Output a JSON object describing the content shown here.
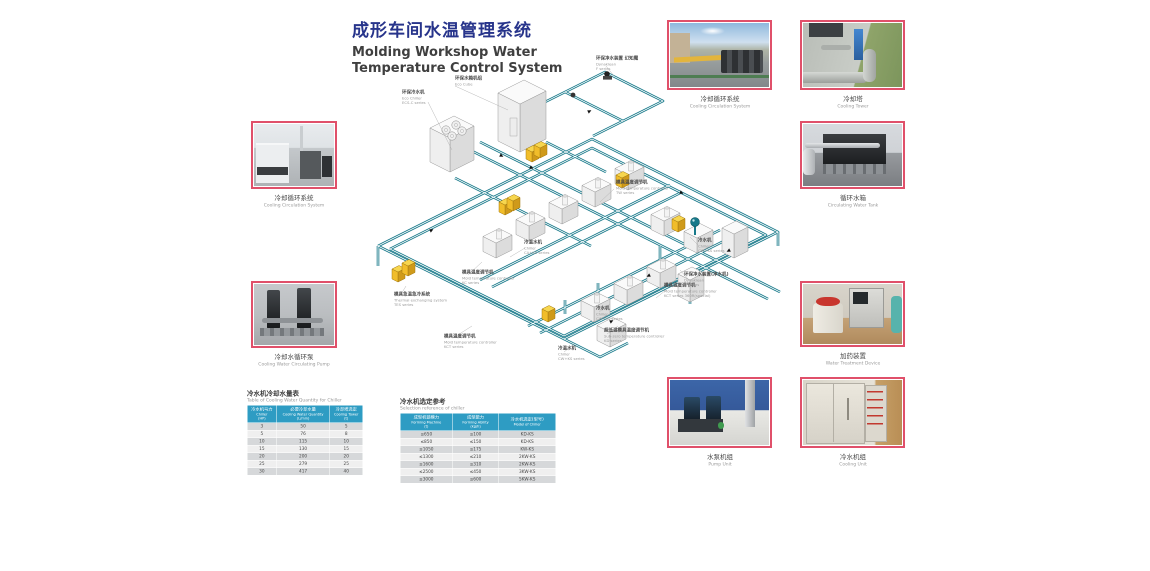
{
  "title": {
    "zh": "成形车间水温管理系统",
    "en_line1": "Molding Workshop Water",
    "en_line2": "Temperature Control System"
  },
  "photos": {
    "left_top": {
      "zh": "冷却循环系统",
      "en": "Cooling Circulation System"
    },
    "left_bottom": {
      "zh": "冷却水循环泵",
      "en": "Cooling Water Circulating Pump"
    },
    "top_1": {
      "zh": "冷却循环系统",
      "en": "Cooling Circulation System"
    },
    "top_2": {
      "zh": "冷却塔",
      "en": "Cooling Tower"
    },
    "right_1": {
      "zh": "循环水箱",
      "en": "Circulating Water Tank"
    },
    "right_2": {
      "zh": "加药装置",
      "en": "Water Treatment Device"
    },
    "bottom_1": {
      "zh": "水泵机组",
      "en": "Pump Unit"
    },
    "bottom_2": {
      "zh": "冷水机组",
      "en": "Cooling Unit"
    }
  },
  "diagram": {
    "labels": [
      {
        "zh": "环保水箱机组",
        "en": "Eco Cube",
        "series": ""
      },
      {
        "zh": "环保冷水机",
        "en": "Eco Chiller",
        "series": "ECS-C series"
      },
      {
        "zh": "环保净水装置 幻知魔",
        "en": "Dynaklean",
        "series": "F series"
      },
      {
        "zh": "模具温度调节机",
        "en": "Mold temperature controller",
        "series": "TW series"
      },
      {
        "zh": "冷温水机",
        "en": "Chiller",
        "series": "CA+KS series"
      },
      {
        "zh": "模具温度调节机",
        "en": "Mold temperature controller",
        "series": "KC series"
      },
      {
        "zh": "模具急温急冷系统",
        "en": "Thermal exchanging system",
        "series": "TES series"
      },
      {
        "zh": "模具温度调节机",
        "en": "Mold temperature controller",
        "series": "KCT series"
      },
      {
        "zh": "模具温度调节机",
        "en": "Mold temperature controller",
        "series": "KCT series 360R(special)"
      },
      {
        "zh": "冷水机",
        "en": "Chiller",
        "series": "CW+KS series"
      },
      {
        "zh": "环保净水装置(净水机)",
        "en": "Dynaklean",
        "series": "D series"
      },
      {
        "zh": "冷水机",
        "en": "Chiller",
        "series": "CW+KS series"
      },
      {
        "zh": "超低温模具温度调节机",
        "en": "Sub-zero temperature controller",
        "series": "KD series"
      },
      {
        "zh": "冷温水机",
        "en": "Chiller",
        "series": "CW+KS series"
      }
    ]
  },
  "tables": {
    "chiller_water": {
      "title_zh": "冷水机冷却水量表",
      "title_en": "Table of Cooling Water Quantity for Chiller",
      "columns": [
        {
          "zh": "冷水机马力",
          "en": "Chiller",
          "unit": "(HP)"
        },
        {
          "zh": "必要冷却水量",
          "en": "Cooling Water Quantity",
          "unit": "(L/min)"
        },
        {
          "zh": "冷却塔选定",
          "en": "Cooling Tower",
          "unit": "(t)"
        }
      ],
      "rows": [
        [
          "3",
          "50",
          "5"
        ],
        [
          "5",
          "76",
          "8"
        ],
        [
          "10",
          "115",
          "10"
        ],
        [
          "15",
          "130",
          "15"
        ],
        [
          "20",
          "200",
          "20"
        ],
        [
          "25",
          "279",
          "25"
        ],
        [
          "30",
          "417",
          "40"
        ]
      ]
    },
    "chiller_selection": {
      "title_zh": "冷水机选定参考",
      "title_en": "Selection reference of chiller",
      "columns": [
        {
          "zh": "成型机锁模力",
          "en": "Forming Machine",
          "unit": "(t)"
        },
        {
          "zh": "成型能力",
          "en": "Forming Ability",
          "unit": "(kg/h)"
        },
        {
          "zh": "冷水机选定(型号)",
          "en": "Model of Chiller",
          "unit": ""
        }
      ],
      "rows": [
        [
          "≤650",
          "≤100",
          "KD-KS"
        ],
        [
          "≤850",
          "≤150",
          "KD-KS"
        ],
        [
          "≤1050",
          "≤175",
          "KW-KS"
        ],
        [
          "≤1300",
          "≤210",
          "2KW-KS"
        ],
        [
          "≤1600",
          "≤310",
          "2KW-KS"
        ],
        [
          "≤2500",
          "≤450",
          "3KW-KS"
        ],
        [
          "≤3000",
          "≤600",
          "5KW-KS"
        ]
      ]
    }
  },
  "colors": {
    "title_blue": "#27348b",
    "photo_border": "#e0506a",
    "pipe_teal": "#17798a",
    "table_header": "#2e9cc3",
    "machine_yellow": "#f0b929"
  }
}
